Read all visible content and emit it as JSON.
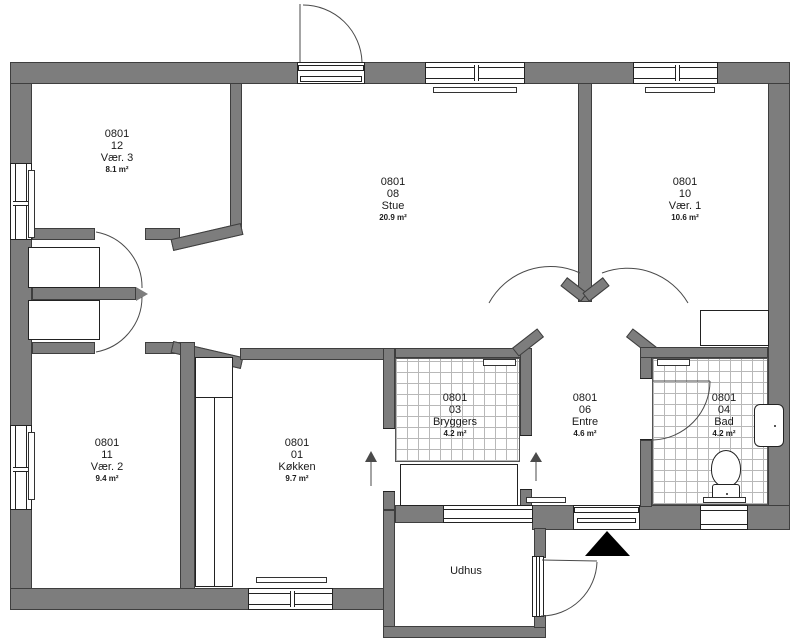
{
  "colors": {
    "wall": "#7d7d7d",
    "outline": "#3e3e3e",
    "tile_line": "#b8b8b8",
    "symbol": "#4a4a4a",
    "marker": "#000000",
    "text": "#1a1a1a"
  },
  "rooms": [
    {
      "property_id": "0801",
      "room_number": "12",
      "room_name": "Vær. 3",
      "area_label": "8.1 m²"
    },
    {
      "property_id": "0801",
      "room_number": "08",
      "room_name": "Stue",
      "area_label": "20.9 m²"
    },
    {
      "property_id": "0801",
      "room_number": "10",
      "room_name": "Vær. 1",
      "area_label": "10.6 m²"
    },
    {
      "property_id": "0801",
      "room_number": "11",
      "room_name": "Vær. 2",
      "area_label": "9.4 m²"
    },
    {
      "property_id": "0801",
      "room_number": "01",
      "room_name": "Køkken",
      "area_label": "9.7 m²"
    },
    {
      "property_id": "0801",
      "room_number": "03",
      "room_name": "Bryggers",
      "area_label": "4.2 m²"
    },
    {
      "property_id": "0801",
      "room_number": "06",
      "room_name": "Entre",
      "area_label": "4.6 m²"
    },
    {
      "property_id": "0801",
      "room_number": "04",
      "room_name": "Bad",
      "area_label": "4.2 m²"
    }
  ],
  "outbuilding": {
    "name": "Udhus"
  }
}
